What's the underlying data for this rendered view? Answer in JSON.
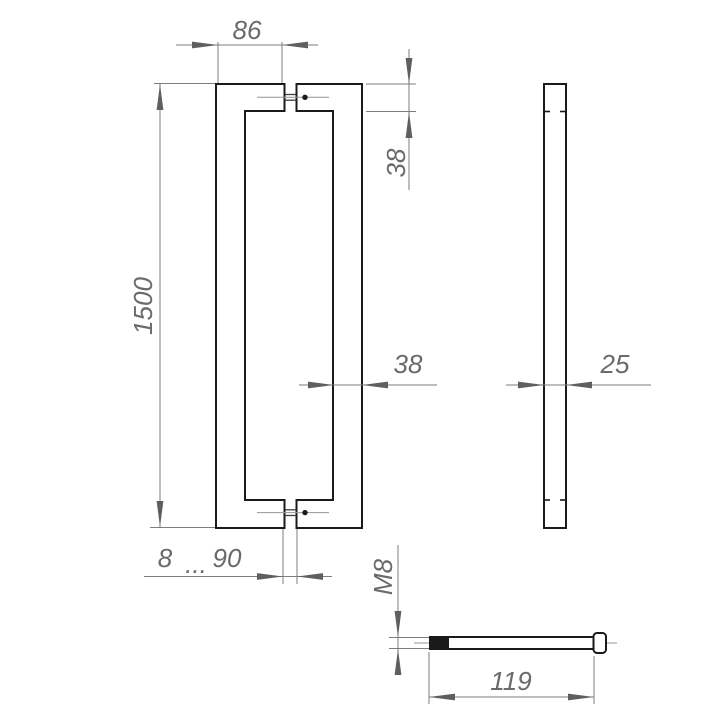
{
  "drawing": {
    "type": "technical-dimension-drawing",
    "subject": "door pull handle, front view, side view and mounting screw",
    "labels": {
      "width_86": "86",
      "bar_thickness_38": "38",
      "height_1500": "1500",
      "tube_width_38": "38",
      "side_depth_25": "25",
      "range_min_8": "8",
      "range_dots": "...",
      "range_max_90": "90",
      "thread_m8": "M8",
      "screw_length_119": "119"
    },
    "colors": {
      "object_line": "#1a1a1a",
      "dimension_line": "#7d7d7d",
      "arrow": "#5f5f5f",
      "text": "#6a6a6a",
      "background": "#ffffff"
    }
  }
}
